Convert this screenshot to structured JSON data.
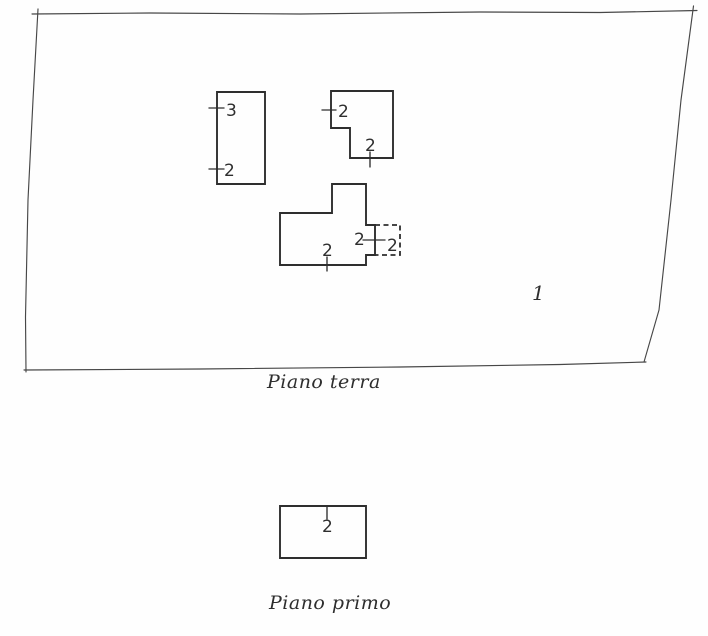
{
  "theme": {
    "paper_color": "#fefefe",
    "ink_color": "#2e2e2e",
    "boundary_ink": "#474747"
  },
  "ground_floor": {
    "caption": "Piano terra",
    "parcel_number": "1",
    "building_left": {
      "tick_labels": [
        "3",
        "2"
      ]
    },
    "building_top": {
      "tick_labels": [
        "2",
        "2"
      ]
    },
    "building_main": {
      "tick_labels": [
        "2",
        "2"
      ],
      "annex_label": "2"
    }
  },
  "first_floor": {
    "caption": "Piano primo",
    "unit_label": "2"
  }
}
